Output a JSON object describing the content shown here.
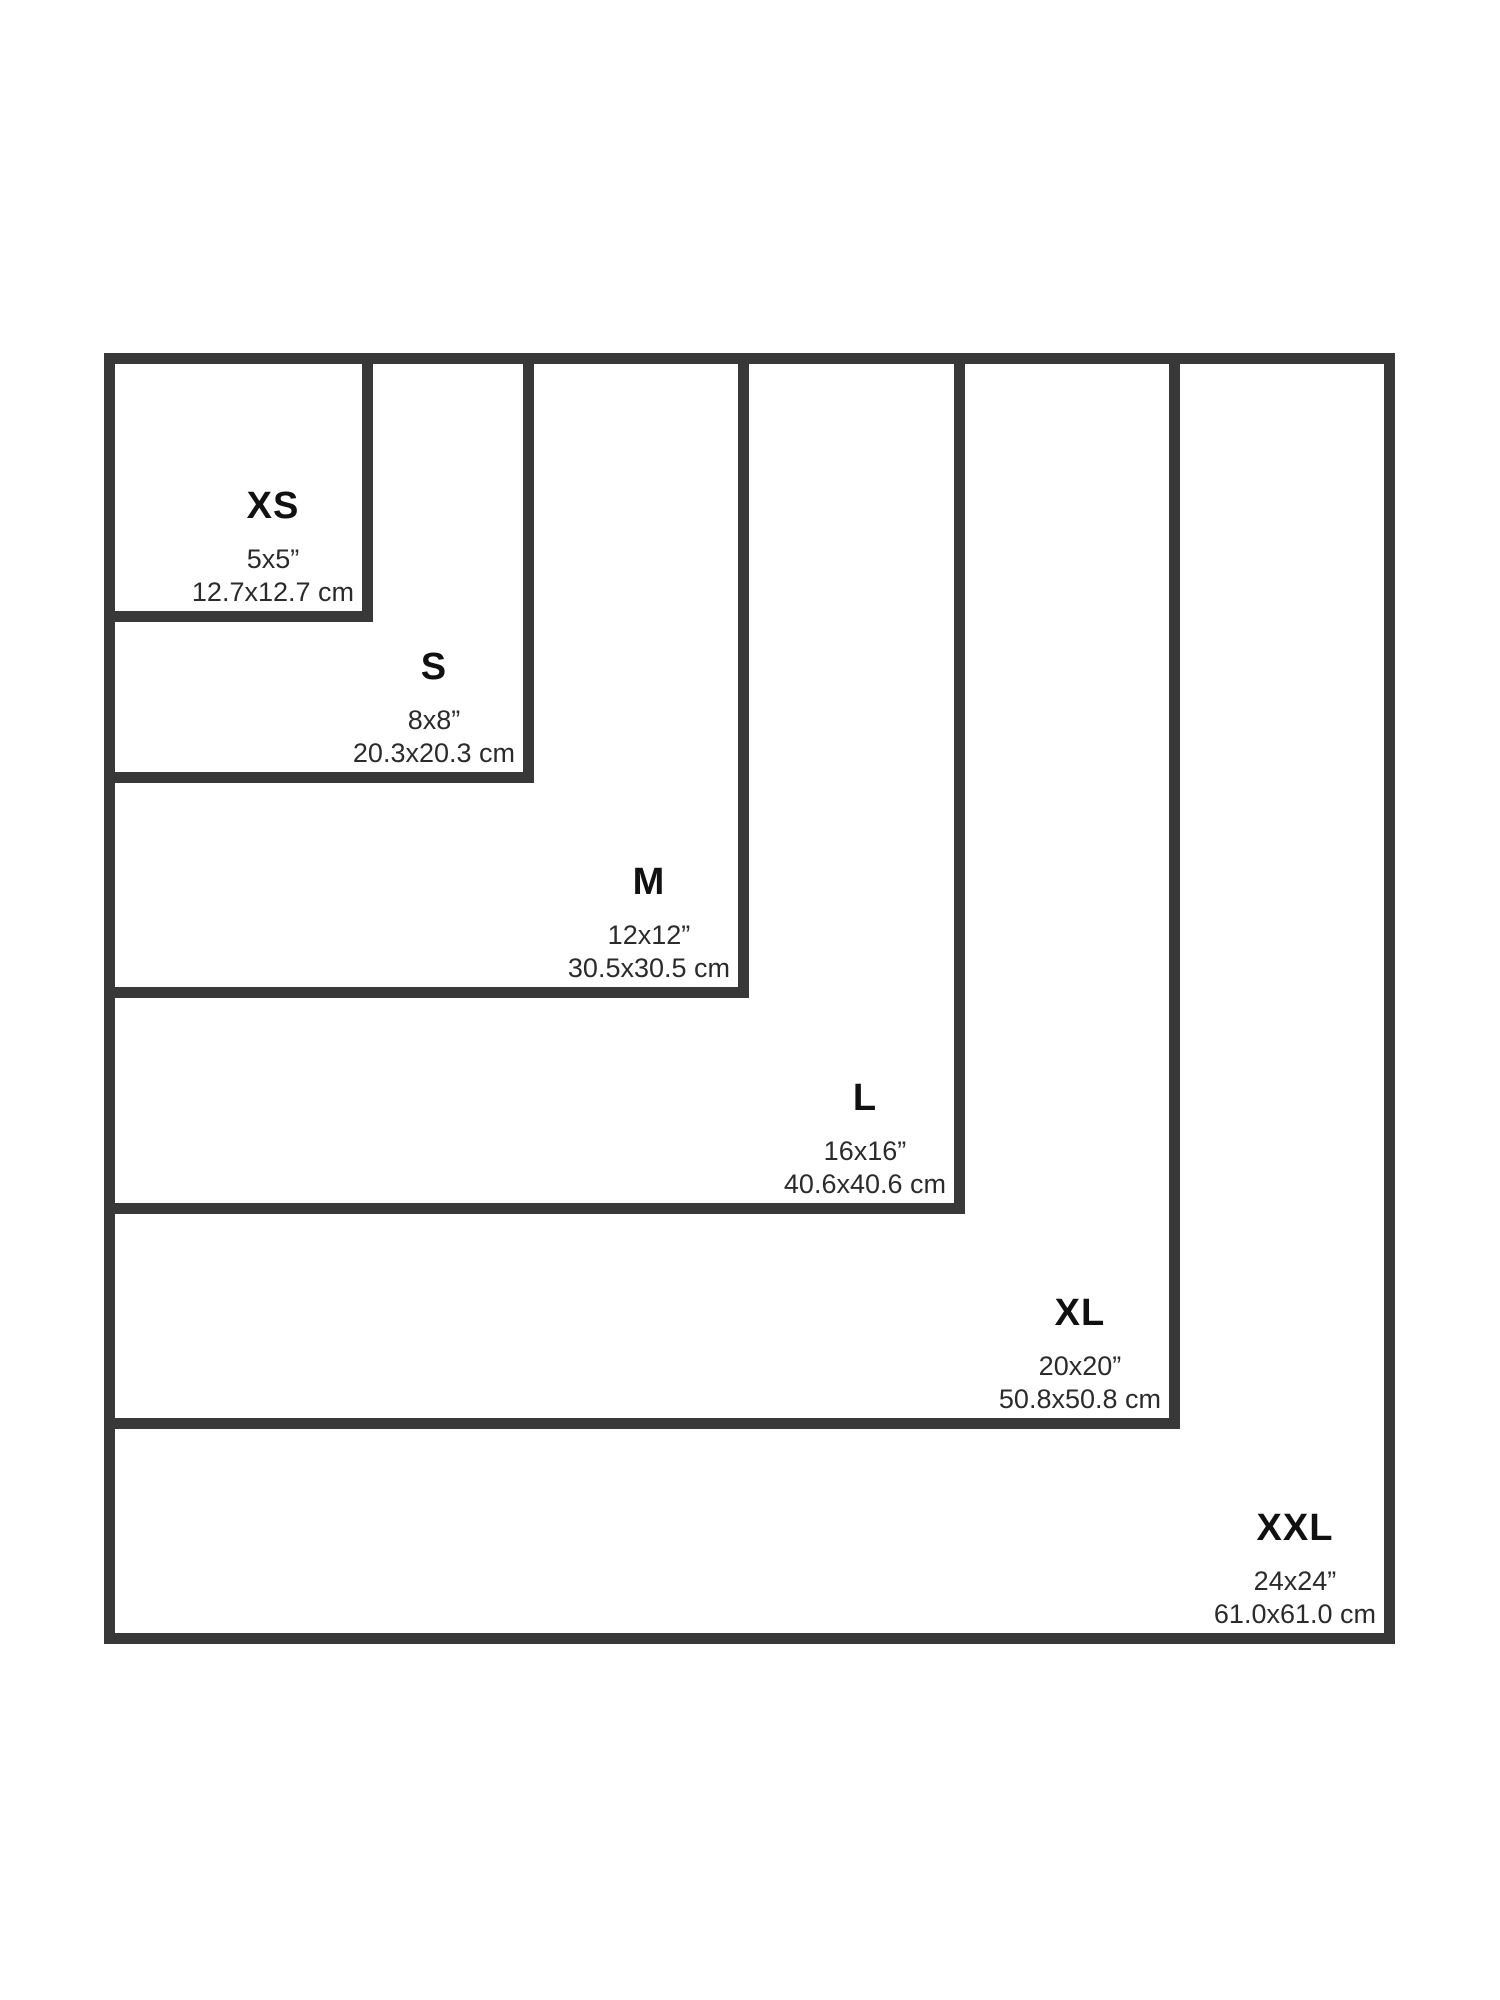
{
  "theme": {
    "background": "#ffffff",
    "border_color": "#383838",
    "letter_color": "#111111",
    "dimension_text_color": "#2b2b2b"
  },
  "size_chart": {
    "sizes": [
      {
        "id": "xs",
        "label": "XS",
        "inches": "5x5”",
        "cm": "12.7x12.7 cm",
        "side_px": 269
      },
      {
        "id": "s",
        "label": "S",
        "inches": "8x8”",
        "cm": "20.3x20.3 cm",
        "side_px": 430
      },
      {
        "id": "m",
        "label": "M",
        "inches": "12x12”",
        "cm": "30.5x30.5 cm",
        "side_px": 645
      },
      {
        "id": "l",
        "label": "L",
        "inches": "16x16”",
        "cm": "40.6x40.6 cm",
        "side_px": 861
      },
      {
        "id": "xl",
        "label": "XL",
        "inches": "20x20”",
        "cm": "50.8x50.8 cm",
        "side_px": 1076
      },
      {
        "id": "xxl",
        "label": "XXL",
        "inches": "24x24”",
        "cm": "61.0x61.0 cm",
        "side_px": 1291
      }
    ]
  }
}
